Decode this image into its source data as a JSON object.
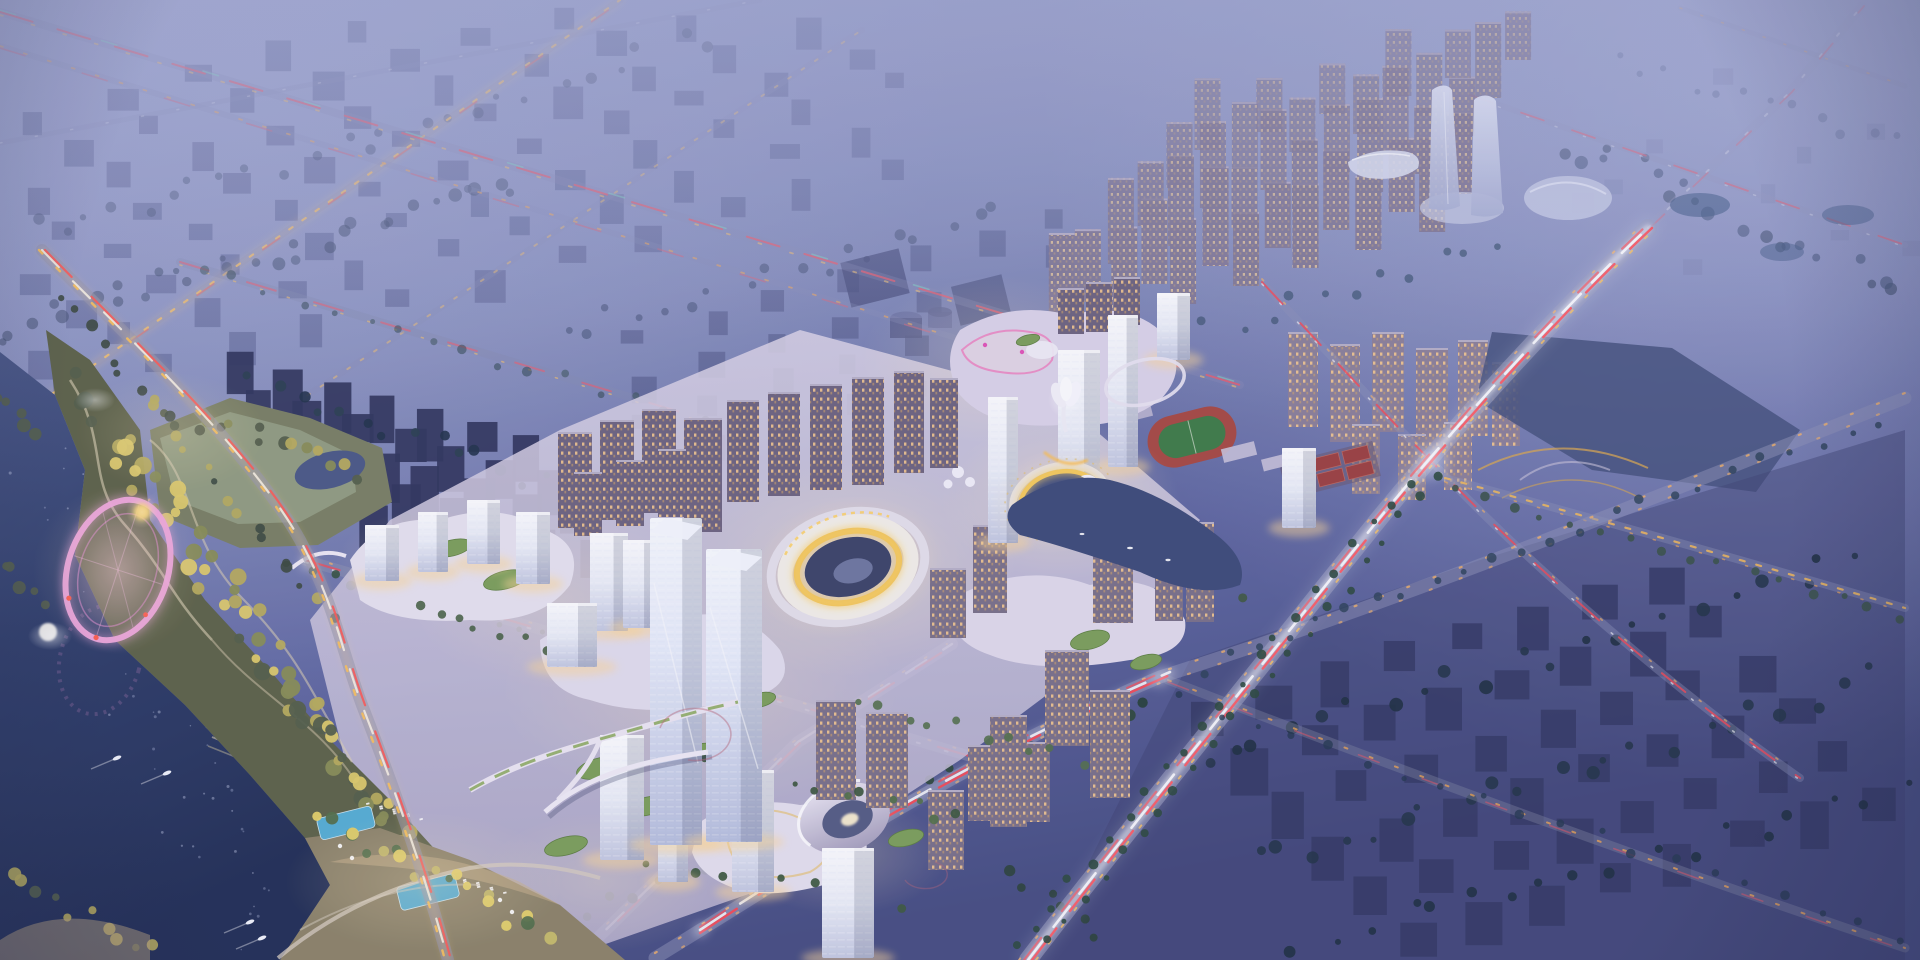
{
  "scene": {
    "type": "architectural-aerial-rendering",
    "time_of_day": "dusk",
    "description": "Dusk aerial rendering of a new city district masterplan: an illuminated CBD with crystalline glass towers, a golden ring arena and a golden ring pavilion over water, a waterfront park with a pink illuminated ferris loop, a lake with boats, beach pools, sports fields, highways with red and white light trails, and a residential tower grid fading into blue haze toward twin sail-shaped towers.",
    "landmarks": [
      "hazy low-rise city blocks",
      "grid of residential towers with lit windows",
      "twin sail-shaped towers",
      "oval exhibition dome",
      "illuminated CBD with crystalline glass towers",
      "golden ring arena",
      "golden ring pavilion over water",
      "white lotus pavilion",
      "elevated circular skywalk",
      "curved mall podium with green roofs",
      "oval concert hall with swirl roof",
      "athletics track",
      "tennis courts",
      "canal with boats",
      "highways with light trails",
      "tree-lined avenues",
      "waterfront park",
      "pink illuminated ferris loop",
      "lake with boats and wakes",
      "beach pools and loungers"
    ],
    "counts": {
      "lake_boats": 5,
      "canal_boats": 3,
      "swimming_pools": 2,
      "golden_rings": 2,
      "sail_towers": 2,
      "tennis_courts": 6
    }
  },
  "palette": {
    "dusk_haze": "#9ba2cc",
    "sky_light": "#b3b9dd",
    "city_shadow": "#31365c",
    "dark_slab": "#343a64",
    "water_deep": "#222f55",
    "water_surface": "#31406b",
    "illuminated_white": "#eef1f9",
    "warm_glow": "#ffe9bc",
    "window_warm": "#ffcf8e",
    "gold_ring": "#f3c34f",
    "light_trail_red": "#ff4750",
    "light_trail_white": "#ffffff",
    "streetlight_amber": "#ffb763",
    "tree_dark": "#243448",
    "tree_lit": "#b9ae5c",
    "park_lawn": "#96a183",
    "pink_loop": "#ee9fd8",
    "neon_magenta": "#e255b8",
    "sports_field_green": "#3f7d46",
    "track_red": "#a84a42",
    "pool_blue": "#57b0d4",
    "green_roof": "#7da15a"
  }
}
